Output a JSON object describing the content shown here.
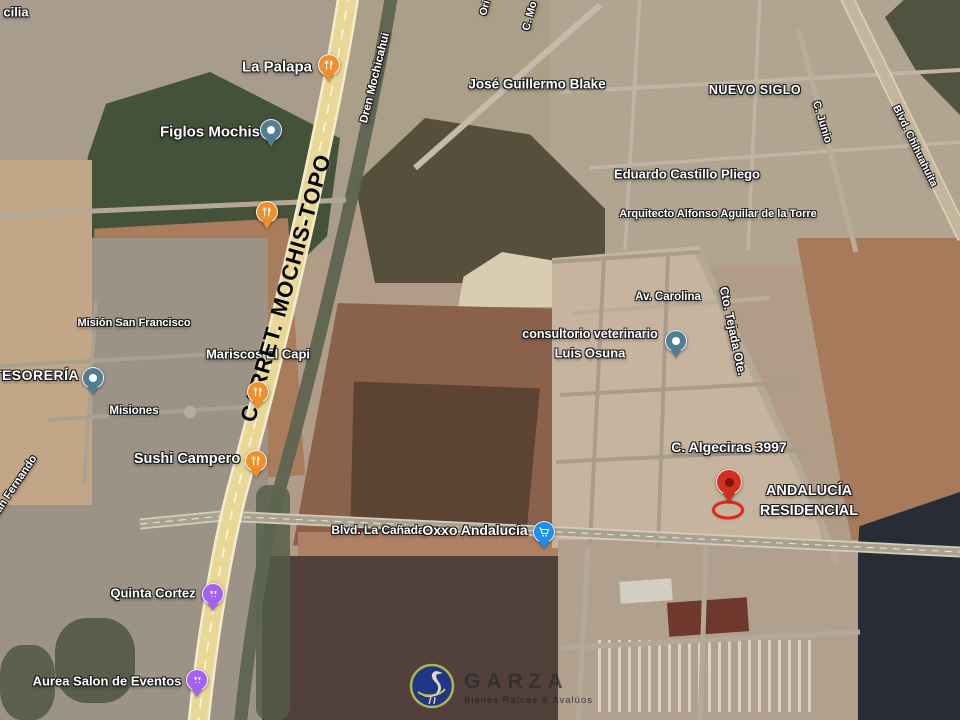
{
  "labels": {
    "partial_top_left": "cilia",
    "la_palapa": "La Palapa",
    "figlos_mochis": "Figlos Mochis",
    "jose_guillermo_blake": "José Guillermo Blake",
    "nuevo_siglo": "NUEVO SIGLO",
    "ori_partial": "Ori",
    "c_mo_partial": "C. Mo",
    "dren_mochicahui": "Dren Mochicahui",
    "c_junio": "C. Junio",
    "blvd_chihuahuita": "Blvd. Chihuahuita",
    "eduardo_castillo_pliego": "Eduardo Castillo Pliego",
    "arquitecto_alfonso": "Arquitecto Alfonso Aguilar de la Torre",
    "mision_san_francisco": "Misión San Francisco",
    "tesoreria": "TESORERÍA",
    "mariscos_el_capi": "Mariscos El Capi",
    "misiones": "Misiones",
    "san_fernando_partial": "San Fernando",
    "sushi_campero": "Sushi Campero",
    "av_carolina": "Av. Carolina",
    "cto_tejada_ote": "Cto. Tejada Ote.",
    "consultorio_line1": "consultorio veterinario",
    "consultorio_line2": "Luis Osuna",
    "c_algeciras": "C. Algeciras 3997",
    "blvd_la_canada": "Blvd. La Cañada",
    "oxxo_andalucia": "Oxxo Andalucía",
    "quinta_cortez": "Quinta Cortez",
    "aurea_salon": "Aurea Salon de Eventos",
    "andalucia_line1": "ANDALUCÍA",
    "andalucia_line2": "RESIDENCIAL",
    "highway": "CARRET. MOCHIS-TOPO"
  },
  "watermark": {
    "brand": "GARZA",
    "tagline": "Bienes Raíces & Avalúos"
  },
  "pins": [
    {
      "id": "la-palapa",
      "label": "La Palapa",
      "kind": "restaurant",
      "icon": "fork-knife-icon",
      "color": "#f0902c"
    },
    {
      "id": "unnamed-restaurant",
      "label": "",
      "kind": "restaurant",
      "icon": "fork-knife-icon",
      "color": "#f0902c"
    },
    {
      "id": "figlos-mochis",
      "label": "Figlos Mochis",
      "kind": "place",
      "icon": "dot-icon",
      "color": "#507e93"
    },
    {
      "id": "tesoreria",
      "label": "TESORERÍA",
      "kind": "place",
      "icon": "dot-icon",
      "color": "#507e93"
    },
    {
      "id": "mariscos-el-capi",
      "label": "Mariscos El Capi",
      "kind": "restaurant",
      "icon": "fork-knife-icon",
      "color": "#f0902c"
    },
    {
      "id": "sushi-campero",
      "label": "Sushi Campero",
      "kind": "restaurant",
      "icon": "fork-knife-icon",
      "color": "#f0902c"
    },
    {
      "id": "consultorio-veterinario",
      "label": "consultorio veterinario Luis Osuna",
      "kind": "place",
      "icon": "dot-icon",
      "color": "#507e93"
    },
    {
      "id": "quinta-cortez",
      "label": "Quinta Cortez",
      "kind": "event-venue",
      "icon": "glasses-icon",
      "color": "#a362f2"
    },
    {
      "id": "aurea-salon",
      "label": "Aurea Salon de Eventos",
      "kind": "event-venue",
      "icon": "glasses-icon",
      "color": "#a362f2"
    },
    {
      "id": "oxxo-andalucia",
      "label": "Oxxo Andalucía",
      "kind": "store",
      "icon": "cart-icon",
      "color": "#1f8cee"
    },
    {
      "id": "selected-property",
      "label": "ANDALUCÍA RESIDENCIAL",
      "kind": "destination",
      "icon": "pin-dot-icon",
      "color": "#d2301f"
    }
  ],
  "colors": {
    "highway": "#e8d795",
    "pin_restaurant": "#f0902c",
    "pin_place": "#507e93",
    "pin_event": "#a362f2",
    "pin_store": "#1f8cee",
    "pin_target": "#d2301f",
    "highlight_red": "#e3251b",
    "watermark_blue": "#1b3590",
    "watermark_ring": "#b9c24e"
  }
}
